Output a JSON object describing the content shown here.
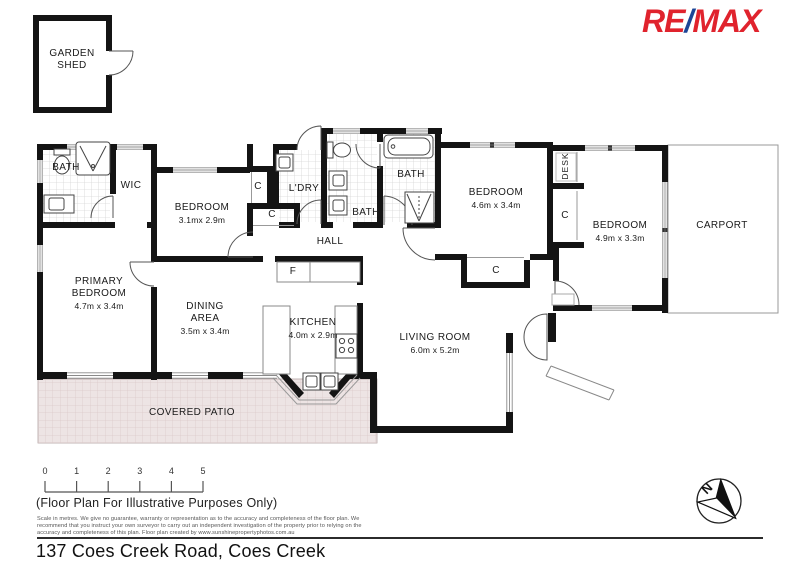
{
  "branding": {
    "re": "RE",
    "slash": "/",
    "max": "MAX",
    "red": "#e0232d",
    "blue": "#1c4596"
  },
  "shed": {
    "line1": "GARDEN",
    "line2": "SHED"
  },
  "rooms": {
    "bath_ensuite": {
      "name": "BATH"
    },
    "wic": {
      "name": "WIC"
    },
    "bedroom2": {
      "name": "BEDROOM",
      "dims": "3.1mx 2.9m"
    },
    "primary": {
      "name": "PRIMARY",
      "name2": "BEDROOM",
      "dims": "4.7m x 3.4m"
    },
    "dining": {
      "name": "DINING",
      "name2": "AREA",
      "dims": "3.5m x 3.4m"
    },
    "closet1": {
      "name": "C"
    },
    "closet2": {
      "name": "C"
    },
    "laundry": {
      "name": "L'DRY"
    },
    "bath_mid": {
      "name": "BATH"
    },
    "bath_main": {
      "name": "BATH"
    },
    "hall": {
      "name": "HALL"
    },
    "fridge": {
      "name": "F"
    },
    "kitchen": {
      "name": "KITCHEN",
      "dims": "4.0m x 2.9m"
    },
    "living": {
      "name": "LIVING ROOM",
      "dims": "6.0m x 5.2m"
    },
    "bedroom3": {
      "name": "BEDROOM",
      "dims": "4.6m x 3.4m"
    },
    "desk": {
      "name": "DESK"
    },
    "closet3": {
      "name": "C"
    },
    "bedroom4": {
      "name": "BEDROOM",
      "dims": "4.9m x 3.3m"
    },
    "closet4": {
      "name": "C"
    },
    "carport": {
      "name": "CARPORT"
    },
    "patio": {
      "name": "COVERED PATIO"
    }
  },
  "scalebar": {
    "labels": [
      "0",
      "1",
      "2",
      "3",
      "4",
      "5"
    ]
  },
  "compass": {
    "n": "N"
  },
  "footer": {
    "note": "(Floor Plan For Illustrative Purposes Only)",
    "disclaimer1": "Scale in metres. We give no guarantee, warranty or representation as to the accuracy and completeness of the floor plan. We",
    "disclaimer2": "recommend that you instruct your own surveyor to carry out an independent investigation of the property prior to relying on the",
    "disclaimer3": "accuracy and completeness of this plan. Floor plan created by www.sunshinepropertyphotos.com.au",
    "address": "137 Coes Creek Road, Coes Creek"
  },
  "colors": {
    "patio_fill": "#ede4e4",
    "patio_grid": "#dcc9c9",
    "wall": "#141414"
  }
}
